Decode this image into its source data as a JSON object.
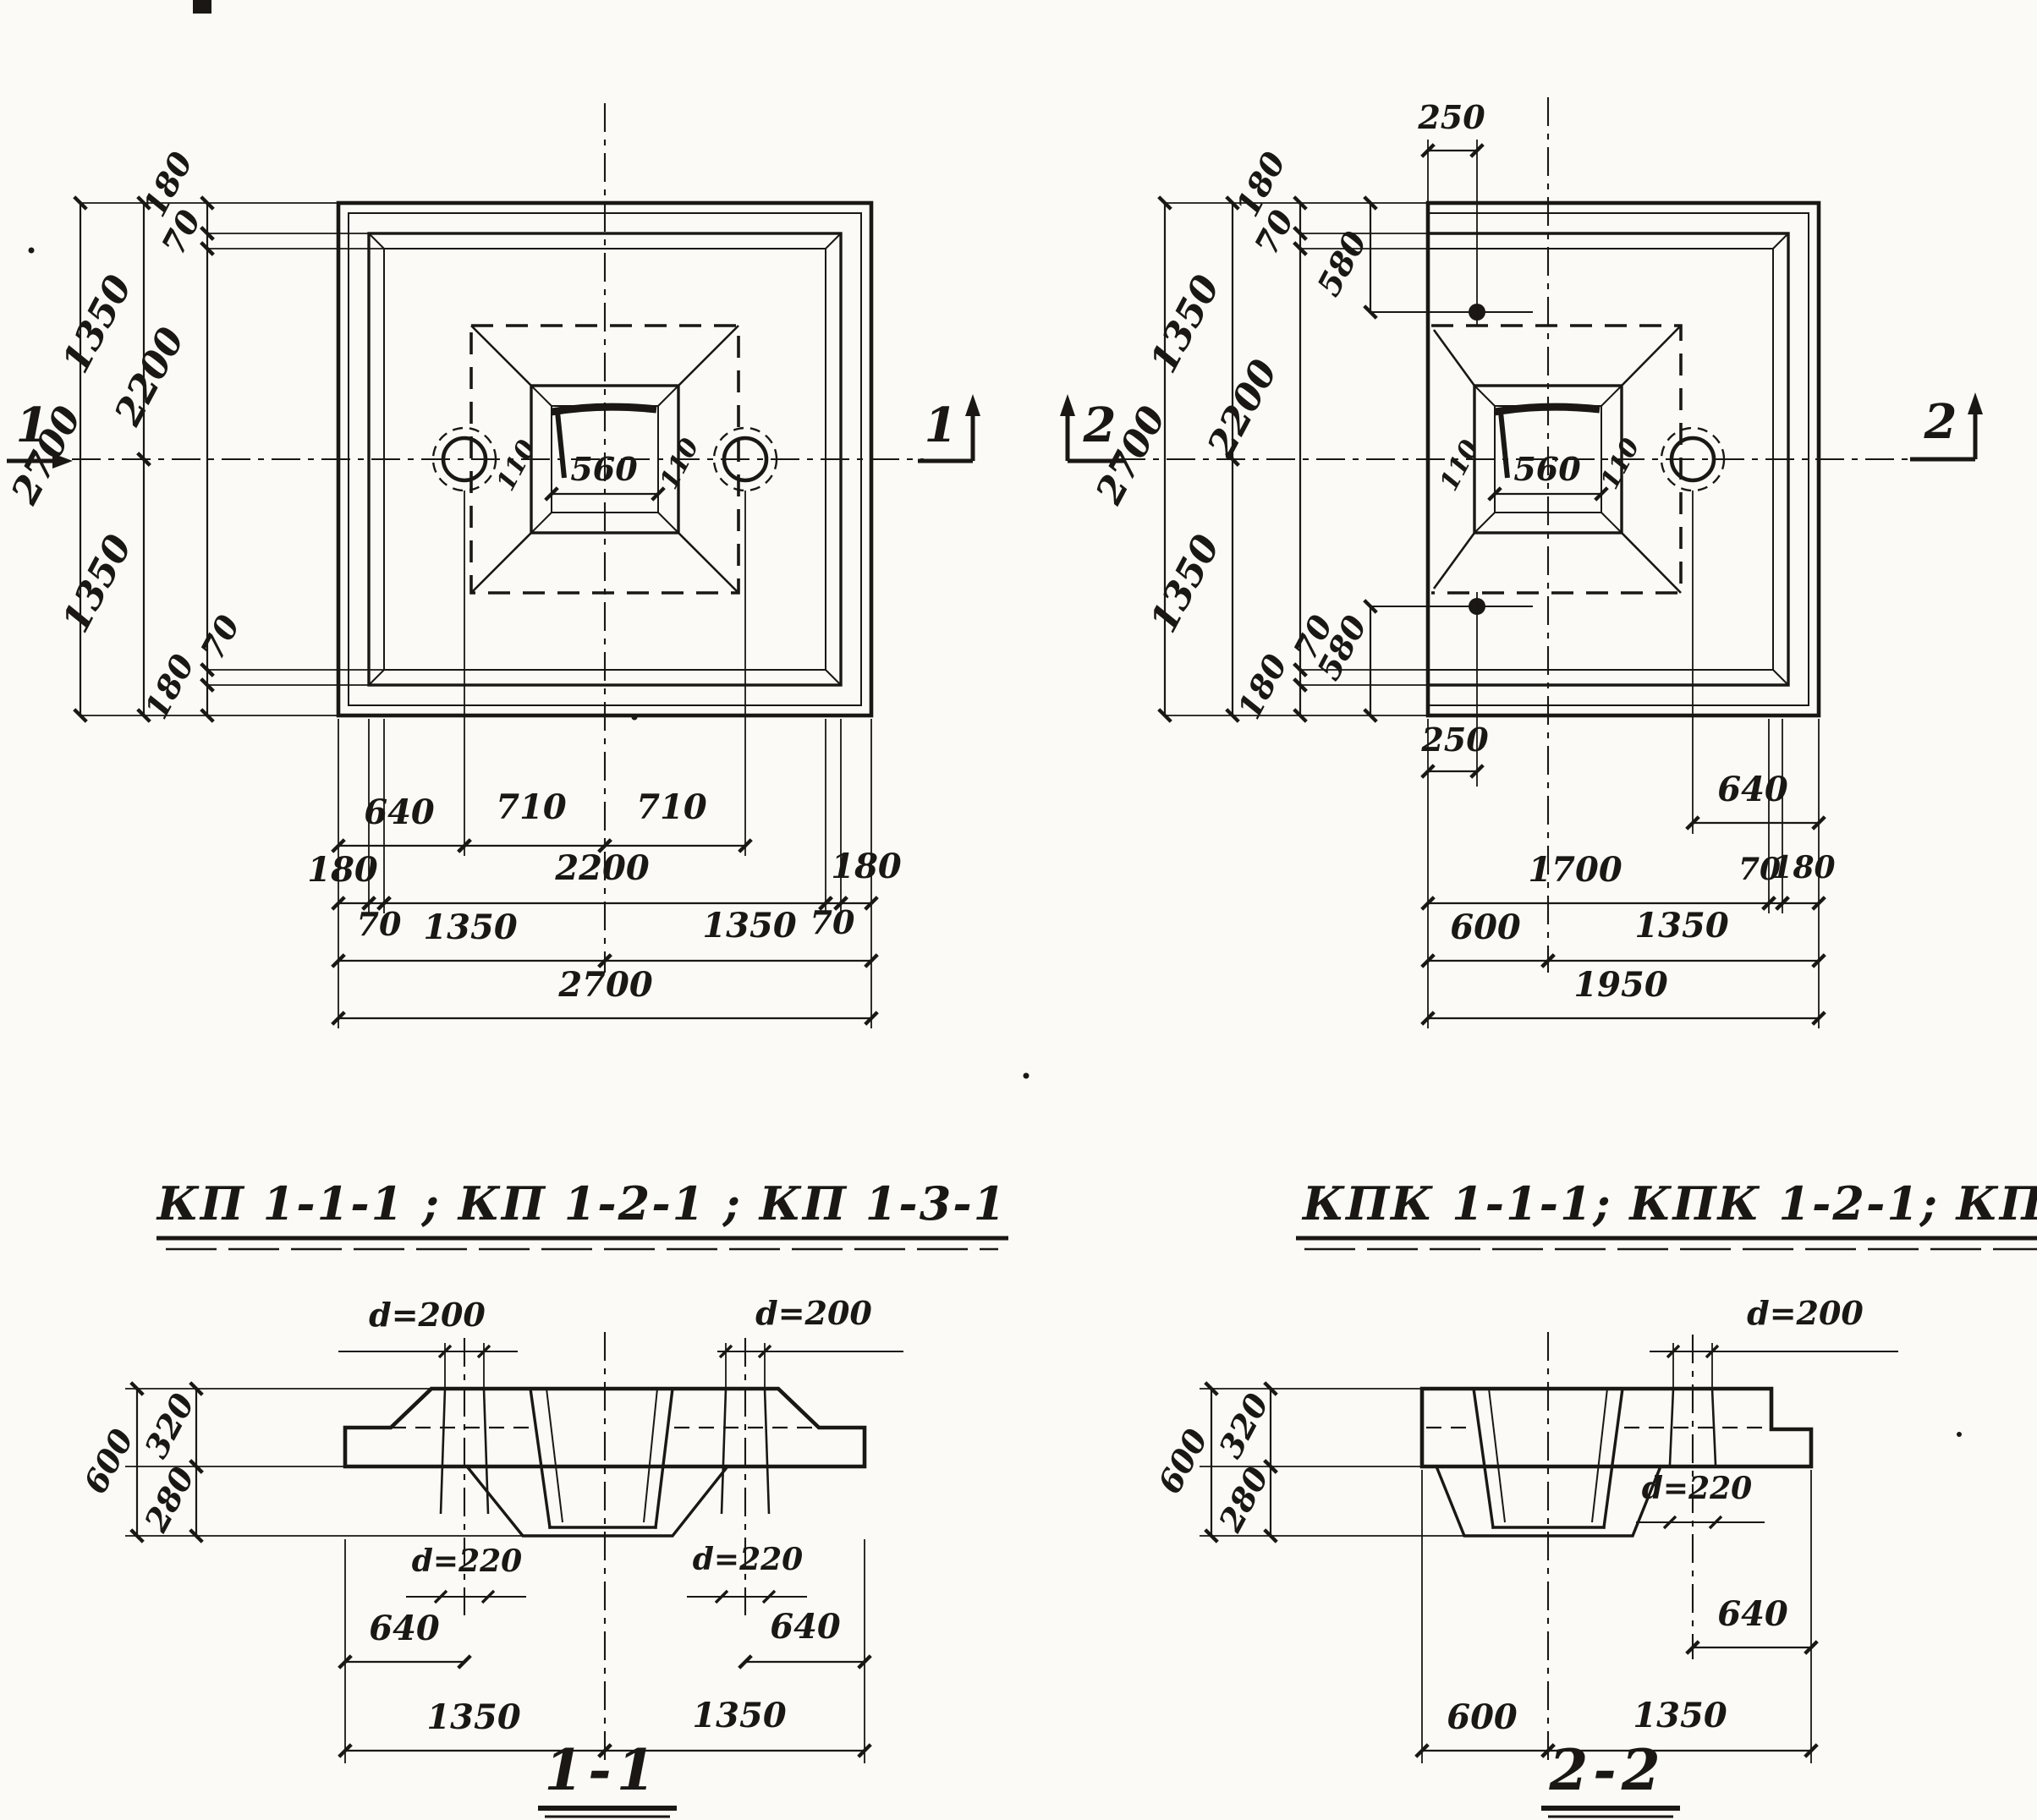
{
  "plans": {
    "left": {
      "title": "КП 1-1-1 ; КП 1-2-1 ; КП 1-3-1",
      "marker_left": "1",
      "marker_right": "1",
      "socket_left": "110",
      "socket_mid": "560",
      "socket_right": "110",
      "v_overall": "2700",
      "v_half_top": "1350",
      "v_half_bottom": "1350",
      "v_edge_top": "180",
      "v_lip_top": "70",
      "v_inner": "2200",
      "v_lip_bottom": "70",
      "v_edge_bottom": "180",
      "r1_hole": "640",
      "r1_left": "710",
      "r1_right": "710",
      "r2_edge_left": "180",
      "r2_lip_left": "70",
      "r2_inner": "2200",
      "r2_lip_right": "70",
      "r2_edge_right": "180",
      "r3_left": "1350",
      "r3_right": "1350",
      "r4_overall": "2700"
    },
    "right": {
      "title": "КПК 1-1-1; КПК 1-2-1; КПК 1-3-1",
      "marker_left": "2",
      "marker_right": "2",
      "socket_left": "110",
      "socket_mid": "560",
      "socket_right": "110",
      "v_overall": "2700",
      "v_half_top": "1350",
      "v_half_bottom": "1350",
      "v_edge_top": "180",
      "v_lip_top": "70",
      "v_inner": "2200",
      "v_lip_bottom": "70",
      "v_edge_bottom": "180",
      "dowel_top_offset": "250",
      "dowel_top_depth": "580",
      "dowel_bottom_depth": "580",
      "dowel_bottom_offset": "250",
      "r1_hole": "640",
      "r2_span": "1700",
      "r2_lip": "70",
      "r2_edge": "180",
      "r3_left": "600",
      "r3_right": "1350",
      "r4_overall": "1950"
    }
  },
  "sections": {
    "s11": {
      "title": "1-1",
      "height": "600",
      "height_top": "320",
      "height_bottom": "280",
      "d_top_left": "d=200",
      "d_top_right": "d=200",
      "d_bottom_left": "d=220",
      "d_bottom_right": "d=220",
      "off_left": "640",
      "off_right": "640",
      "half_left": "1350",
      "half_right": "1350"
    },
    "s22": {
      "title": "2-2",
      "height": "600",
      "height_top": "320",
      "height_bottom": "280",
      "d_top": "d=200",
      "d_bottom": "d=220",
      "off_right": "640",
      "cup_offset": "600",
      "half_right": "1350"
    }
  }
}
